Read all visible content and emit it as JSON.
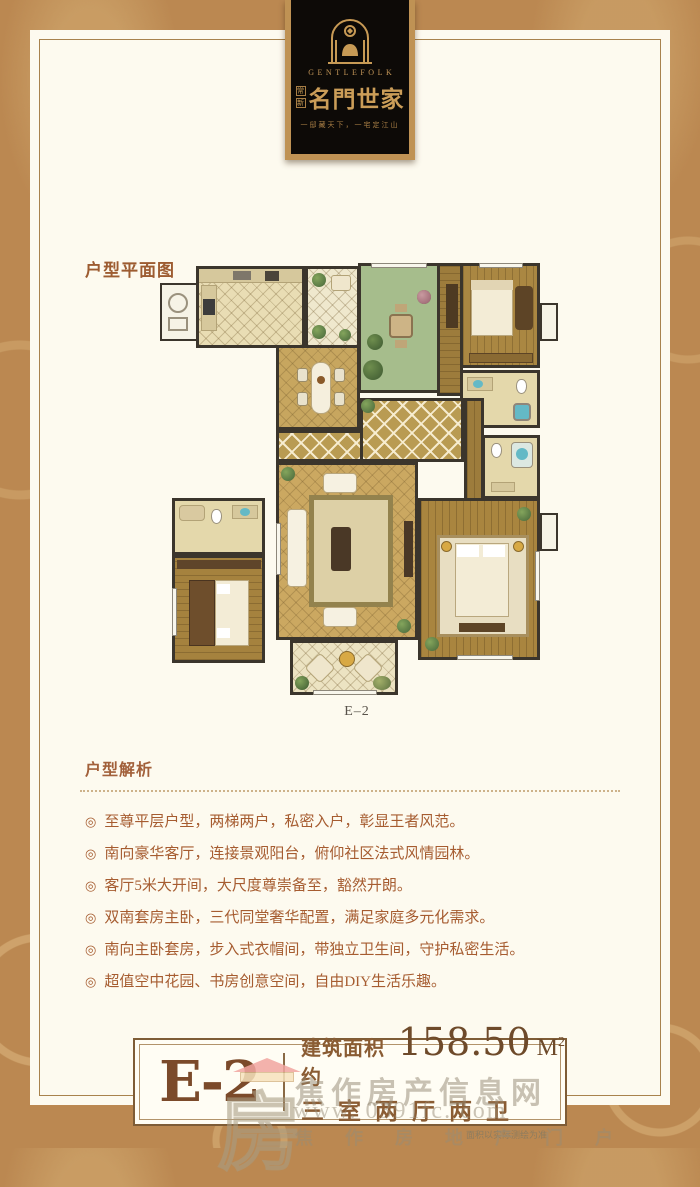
{
  "logo": {
    "brand_en": "GENTLEFOLK",
    "seal_top": "常",
    "seal_bottom": "新",
    "brand_cn": "名門世家",
    "tagline": "一邸藏天下，一宅定江山"
  },
  "plan": {
    "section_label": "户型平面图",
    "caption": "E–2"
  },
  "analysis": {
    "title": "户型解析",
    "bullet_marker": "◎",
    "items": [
      "至尊平层户型，两梯两户，私密入户，彰显王者风范。",
      "南向豪华客厅，连接景观阳台，俯仰社区法式风情园林。",
      "客厅5米大开间，大尺度尊崇备至，豁然开朗。",
      "双南套房主卧，三代同堂奢华配置，满足家庭多元化需求。",
      "南向主卧套房，步入式衣帽间，带独立卫生间，守护私密生活。",
      "超值空中花园、书房创意空间，自由DIY生活乐趣。"
    ]
  },
  "footer": {
    "unit_code": "E-2",
    "area_prefix": "建筑面积约",
    "area_value": "158.50",
    "area_unit": "M",
    "area_sup": "2",
    "config": "三室两厅两卫",
    "disclaimer": "面积以实际测绘为准"
  },
  "watermark": {
    "site_name": "焦作房产信息网",
    "site_url": "www. 0391fc. com",
    "site_slogan": "焦作房地产门户",
    "logo_char": "房"
  },
  "colors": {
    "border_tan": "#bb8851",
    "panel_cream": "#fdfaef",
    "badge_black": "#0d0a07",
    "gold": "#c79a55",
    "text_brown": "#a65c30",
    "footer_brown": "#7b4a2a"
  }
}
